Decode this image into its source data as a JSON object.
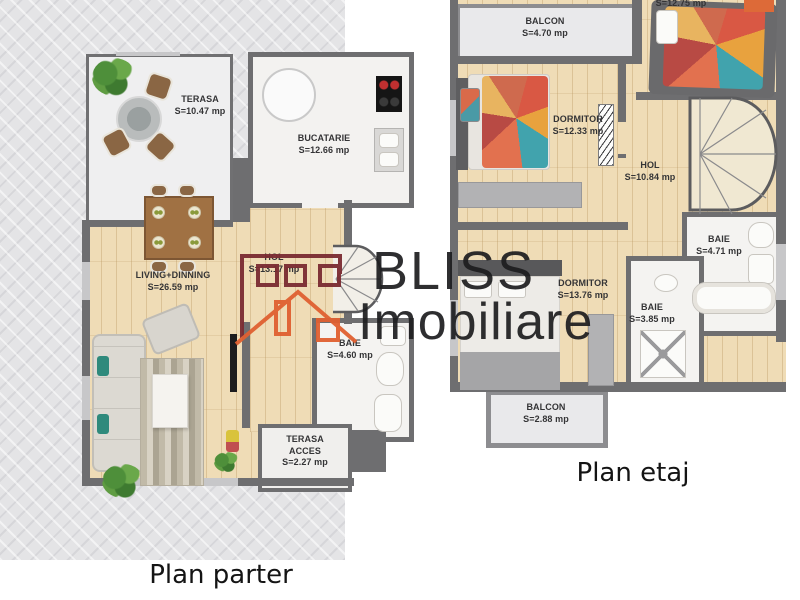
{
  "watermark": {
    "brand_line1": "BLISS",
    "brand_line2": "Imobiliare"
  },
  "plans": [
    {
      "title": "Plan parter",
      "rooms": [
        {
          "name": "TERASA",
          "area": "S=10.47 mp"
        },
        {
          "name": "BUCATARIE",
          "area": "S=12.66 mp"
        },
        {
          "name": "LIVING+DINNING",
          "area": "S=26.59 mp"
        },
        {
          "name": "HOL",
          "area": "S=13.17 mp"
        },
        {
          "name": "BAIE",
          "area": "S=4.60 mp"
        },
        {
          "name": "TERASA ACCES",
          "area": "S=2.27 mp"
        }
      ]
    },
    {
      "title": "Plan etaj",
      "rooms": [
        {
          "name": "BALCON",
          "area": "S=4.70 mp"
        },
        {
          "name": "",
          "area": "S=12.75 mp"
        },
        {
          "name": "DORMITOR",
          "area": "S=12.33 mp"
        },
        {
          "name": "HOL",
          "area": "S=10.84 mp"
        },
        {
          "name": "BAIE",
          "area": "S=4.71 mp"
        },
        {
          "name": "DORMITOR",
          "area": "S=13.76 mp"
        },
        {
          "name": "BAIE",
          "area": "S=3.85 mp"
        },
        {
          "name": "BALCON",
          "area": "S=2.88 mp"
        }
      ]
    }
  ],
  "colors": {
    "wall": "#6e6e70",
    "balcony_wall": "#8d8d90",
    "wood_floor": "#efdcb6",
    "pavement": "#e4e4e6",
    "tile": "#f4f3f1",
    "logo_dark_red": "#7b2c32",
    "logo_orange": "#e06031"
  }
}
